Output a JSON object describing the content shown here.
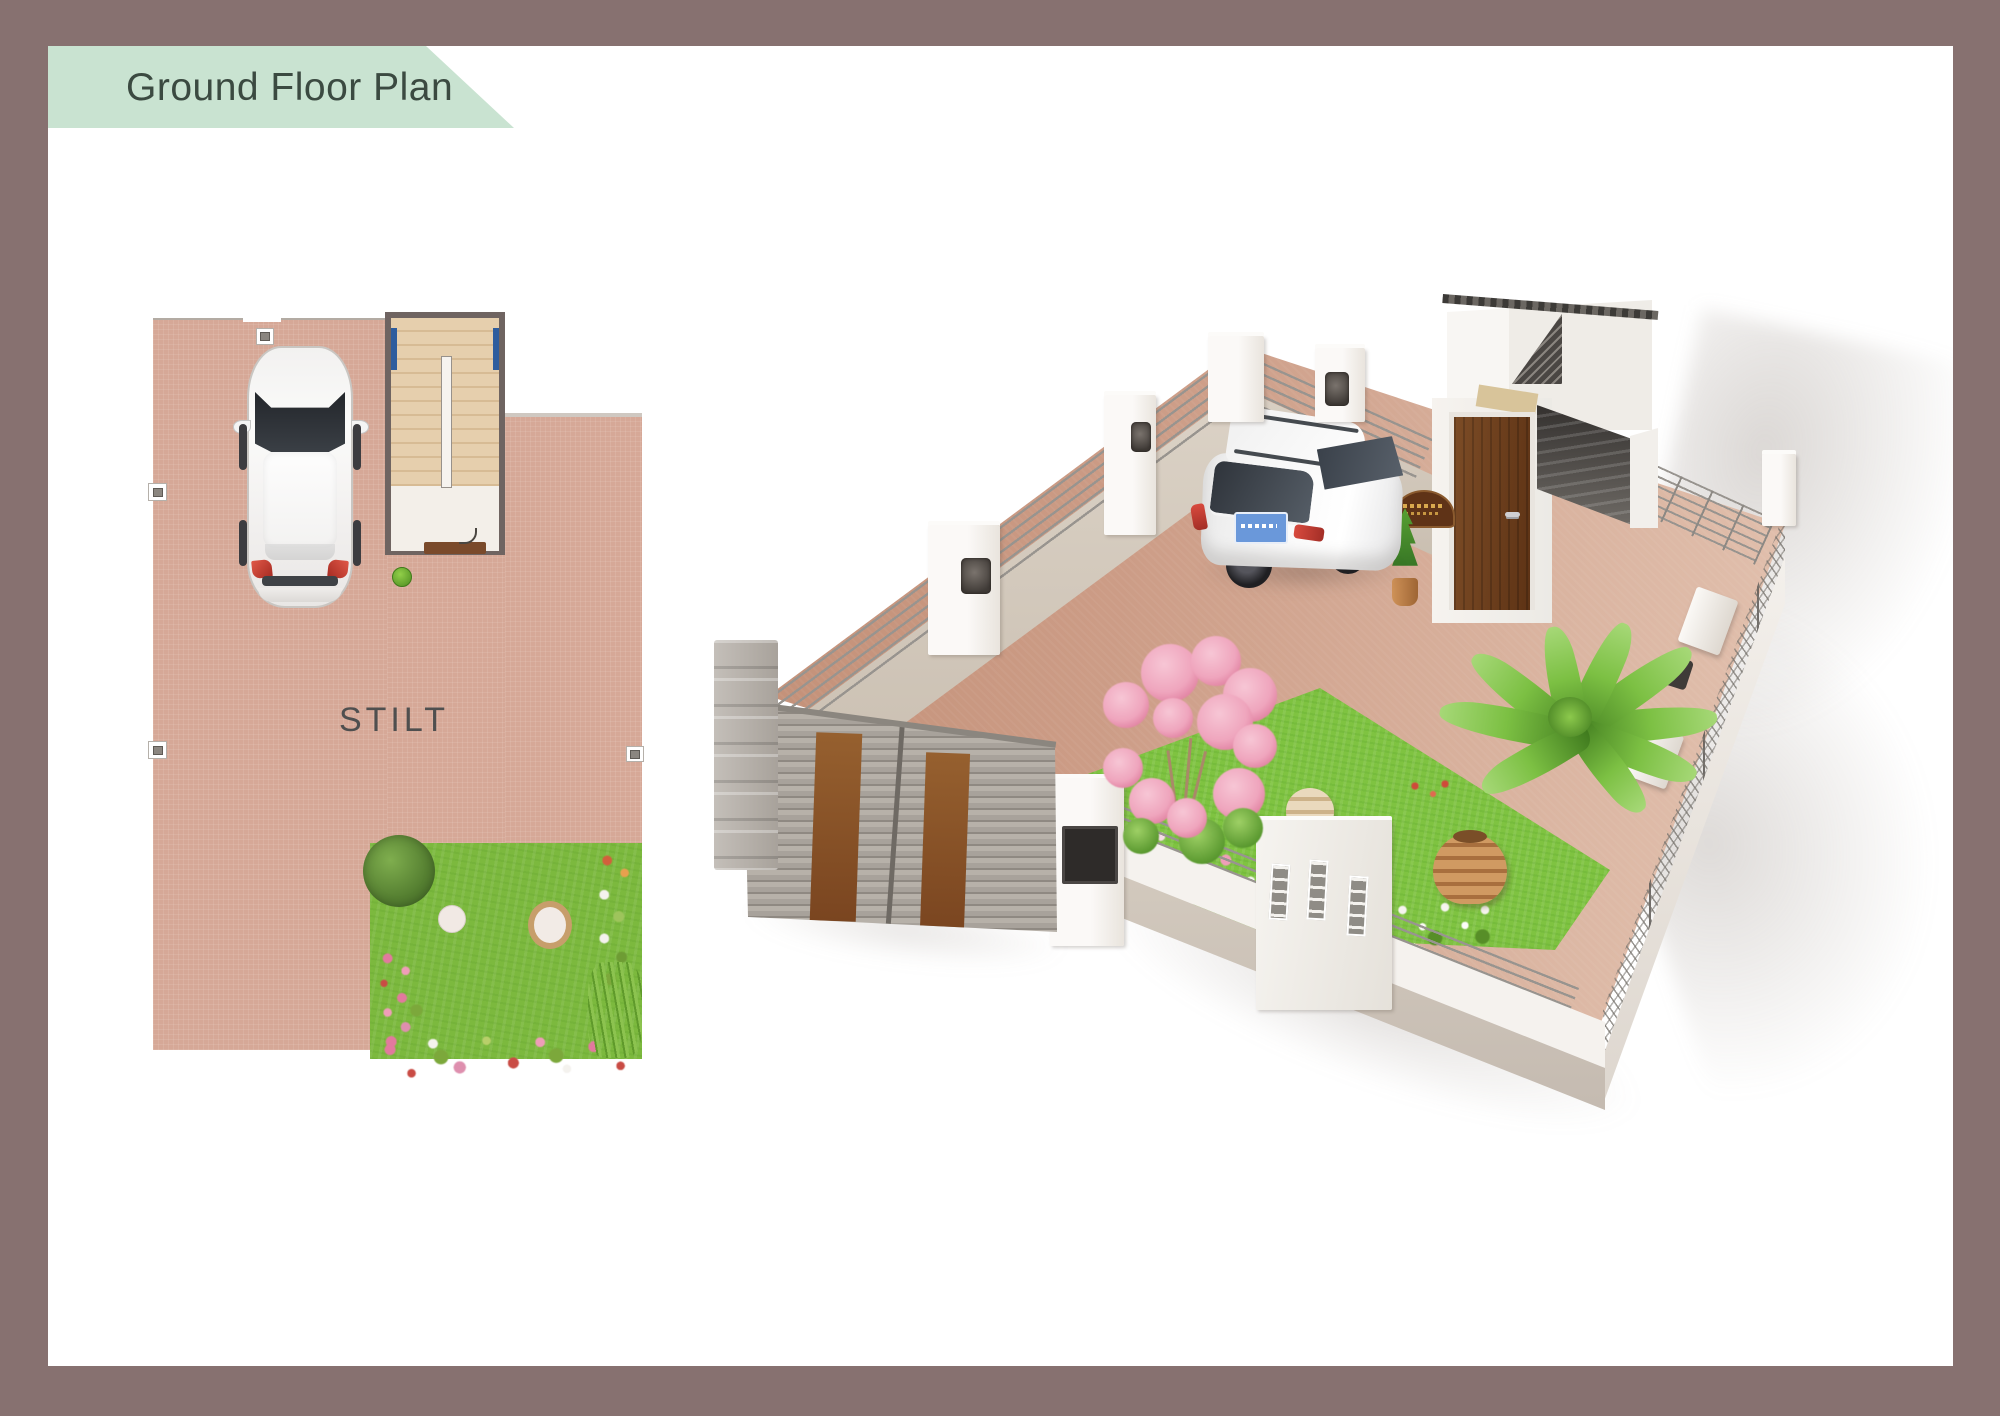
{
  "banner": {
    "title": "Ground Floor Plan"
  },
  "plan2d": {
    "stilt_label": "STILT"
  },
  "theme": {
    "--bg": "#ffffff",
    "--frame": "#877170",
    "--banner-bg": "#c9e3d1",
    "--banner-text": "#3b4a41",
    "--paving": "#d6a897",
    "--lawn2d": "#7cb93e",
    "--stair-wall": "#6f6461",
    "--stair-tread": "#e6cfad",
    "--stair-tread-dark": "#d7bb94",
    "--blue": "#2e5d9e",
    "--mat": "#7a4a2b",
    "--stilt-text": "#4f4f4f",
    "--yard-dark": "#c28f76",
    "--yard-light": "#e3c3b1",
    "--wall-white": "#f5f2ee",
    "--panel-light": "#ded5c9",
    "--panel-dark": "#c7bcae",
    "--pipe": "#98948f",
    "--lawn3d": "#7fc341",
    "--door-light": "#7c4c26",
    "--door-dark": "#5e3315",
    "--gate-slat": "#a8a29b",
    "--gate-plank": "#8a5531",
    "--pot": "#bf8450",
    "--blossom": "#efa5bd",
    "--concrete": "#55514e",
    "--plate-blue": "#6a98da"
  }
}
